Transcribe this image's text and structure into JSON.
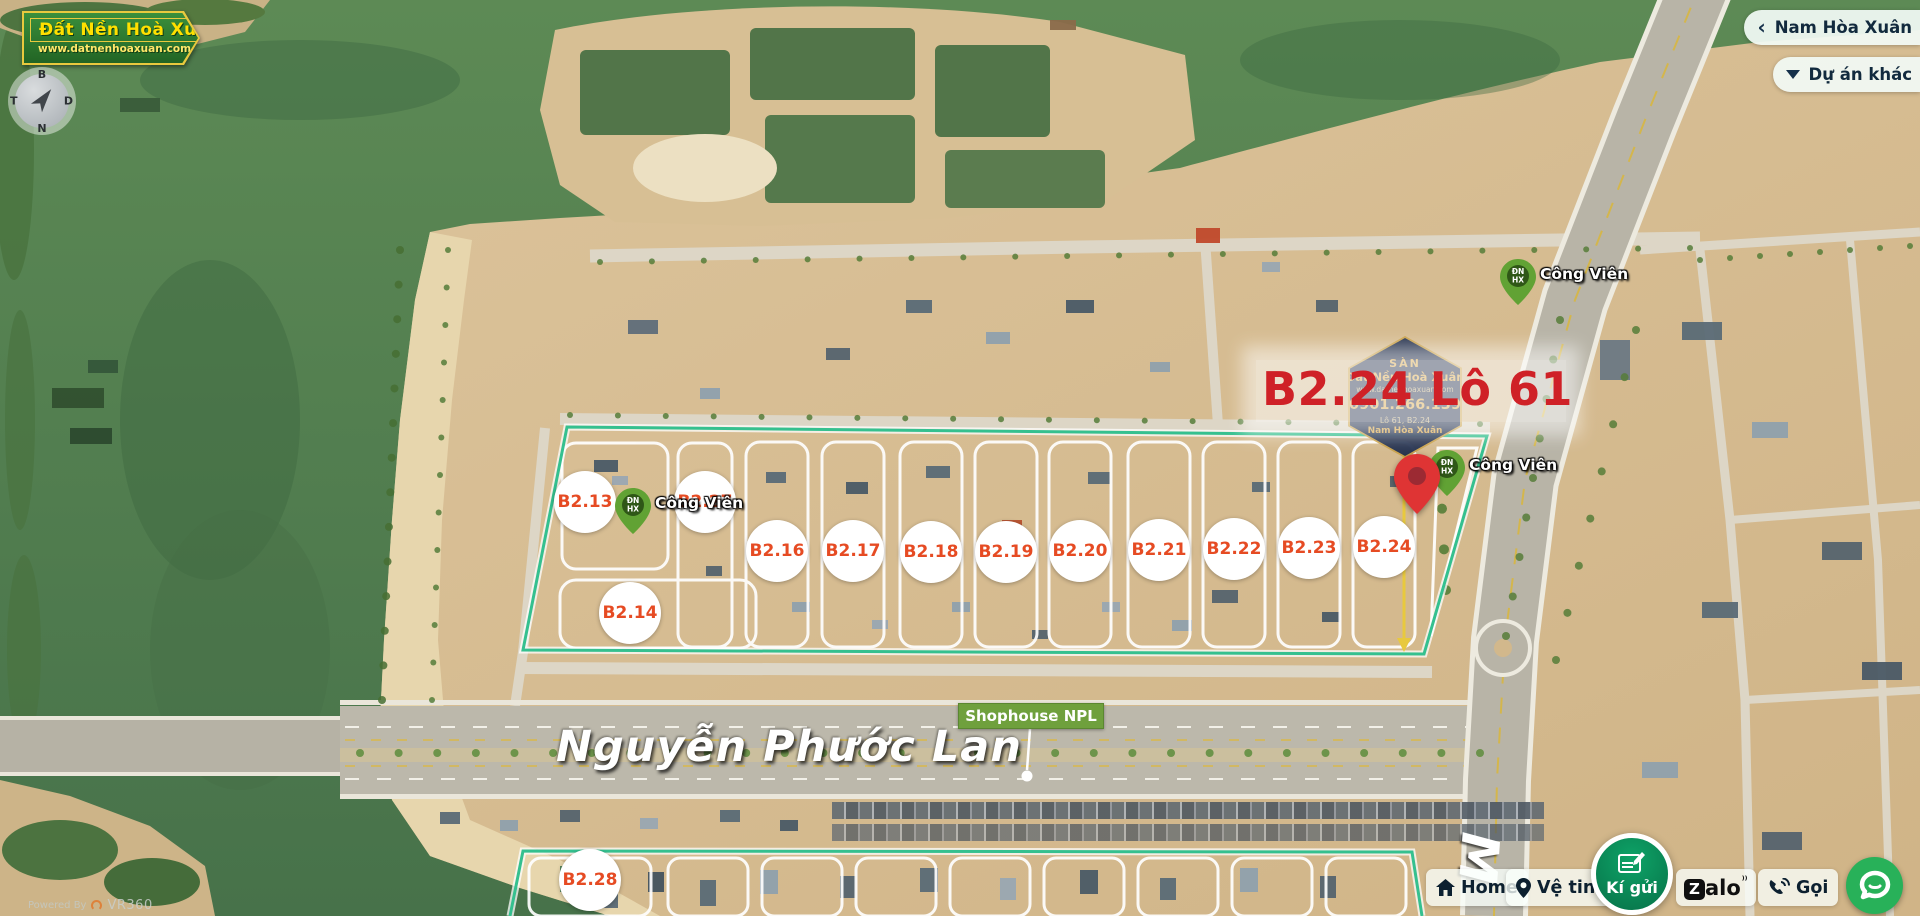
{
  "brand": {
    "name": "Đất Nền Hoà Xuân",
    "website": "www.datnenhoaxuan.com"
  },
  "compass": {
    "top": "B",
    "left": "T",
    "right": "D",
    "bottom": "N"
  },
  "nav": {
    "back_label": "Nam Hòa Xuân",
    "back_icon": "chevron-left",
    "projects_label": "Dự án khác",
    "projects_icon": "caret-down"
  },
  "highlight": {
    "title": "B2.24 Lô 61",
    "color": "#cf2127"
  },
  "watermark": {
    "lines": [
      "SÀN",
      "Đất Nền Hoà Xuân",
      "www.datnenhoaxuan.com",
      "0901.266.139",
      "Lô 61, B2.24",
      "Nam Hòa Xuân"
    ]
  },
  "map": {
    "street_main": "Nguyễn Phước Lan",
    "street_fragment": "M",
    "shophouse_label": "Shophouse NPL",
    "park_label": "Công Viên",
    "park_pin_line1": "ĐN",
    "park_pin_line2": "HX",
    "plots": [
      {
        "label": "B2.13",
        "x": 585,
        "y": 502
      },
      {
        "label": "B2.27",
        "x": 705,
        "y": 502
      },
      {
        "label": "B2.14",
        "x": 630,
        "y": 613
      },
      {
        "label": "B2.16",
        "x": 777,
        "y": 551
      },
      {
        "label": "B2.17",
        "x": 853,
        "y": 551
      },
      {
        "label": "B2.18",
        "x": 931,
        "y": 552
      },
      {
        "label": "B2.19",
        "x": 1006,
        "y": 552
      },
      {
        "label": "B2.20",
        "x": 1080,
        "y": 551
      },
      {
        "label": "B2.21",
        "x": 1159,
        "y": 550
      },
      {
        "label": "B2.22",
        "x": 1234,
        "y": 549
      },
      {
        "label": "B2.23",
        "x": 1309,
        "y": 548
      },
      {
        "label": "B2.24",
        "x": 1384,
        "y": 547
      },
      {
        "label": "B2.28",
        "x": 590,
        "y": 880
      }
    ],
    "park_markers": [
      {
        "x": 633,
        "y": 538,
        "show_label": true
      },
      {
        "x": 1447,
        "y": 500,
        "show_label": true
      },
      {
        "x": 1518,
        "y": 309,
        "show_label": true
      }
    ],
    "selected_pin": {
      "x": 1417,
      "y": 518
    }
  },
  "toolbar": {
    "home": "Home",
    "satellite": "Vệ tinh",
    "consign": "Kí gửi",
    "zalo": "Zalo",
    "call": "Gọi"
  },
  "attribution": {
    "prefix": "Powered By",
    "brand": "VR360"
  },
  "colors": {
    "plot_text": "#e64b23",
    "teal_outline": "#35c08f",
    "title_red": "#cf2127",
    "badge_green": "#2e7d33",
    "badge_yellow": "#ffe000",
    "consign_green": "#0a8f5b",
    "chat_green": "#28b159",
    "shophouse_green": "#6fa03d",
    "pointer_yellow": "#e8c93e"
  }
}
